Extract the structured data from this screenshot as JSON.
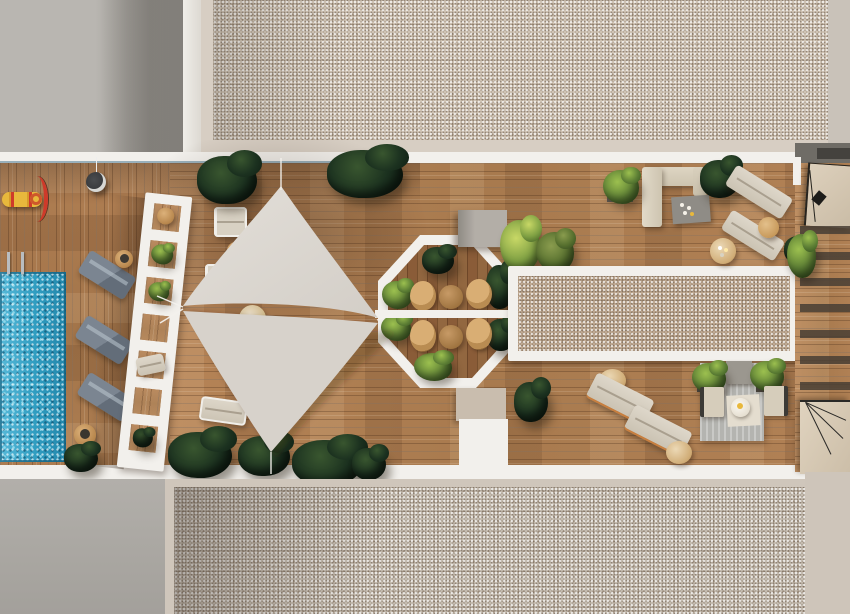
{
  "scene": {
    "title": "rooftop-terrace-aerial-render",
    "description": "Photorealistic top-down 3D rendering of a residential rooftop terrace: swimming pool, slatted pergola, twin shade sails, octagonal dining deck, long gravel skylight planter, lounge and sofa areas, flanked by gravel building roofs",
    "palette": {
      "gravel_top": "#cfc3b4",
      "gravel_bottom": "#c4bbaf",
      "gravel_planter": "#bfa992",
      "concrete": "#aaa7a2",
      "white_trim": "#f2f0ec",
      "wood": "#ad7b50",
      "wood_dark": "#7b4f2e",
      "pool_blue": "#2f9cc0",
      "pool_sparkle": "#8fd8ea",
      "sail": "#dcd8d2",
      "plant_dark": "#1c3220",
      "plant_light": "#5d7f35",
      "cushion_beige": "#cbc3b3",
      "slate_lounger": "#636d79",
      "wicker_tan": "#b9884e",
      "rug_gray": "#b4b4b0",
      "accent_red": "#cf3a2a",
      "accent_yellow": "#e8b83c"
    },
    "objects": [
      {
        "name": "upper-roof-gravel",
        "label": "gravel roof of adjacent building (top)"
      },
      {
        "name": "lower-roof-gravel",
        "label": "gravel roof of adjacent building (bottom)"
      },
      {
        "name": "swimming-pool",
        "label": "rectangular swimming pool with ladder"
      },
      {
        "name": "spring-toy",
        "label": "yellow and red pool toy"
      },
      {
        "name": "slat-pergola",
        "label": "white slatted pergola walkway"
      },
      {
        "name": "shade-sails",
        "label": "two triangular shade sails"
      },
      {
        "name": "octagon-dining",
        "label": "octagonal dining deck with two tables and four wicker chairs"
      },
      {
        "name": "skylight-planter",
        "label": "long white-framed gravel skylight strip"
      },
      {
        "name": "corner-sofa",
        "label": "L-shaped outdoor sofa with coffee table"
      },
      {
        "name": "sun-loungers-pool",
        "label": "three slate-gray sun loungers by the pool"
      },
      {
        "name": "sun-loungers-right",
        "label": "beige sun loungers on the right terrace"
      },
      {
        "name": "lounge-rug",
        "label": "gray rug seating area with two armchairs"
      },
      {
        "name": "stairs",
        "label": "staircase landings at the right edge"
      },
      {
        "name": "planters",
        "label": "dark green hedge planters along terrace edges"
      }
    ]
  }
}
